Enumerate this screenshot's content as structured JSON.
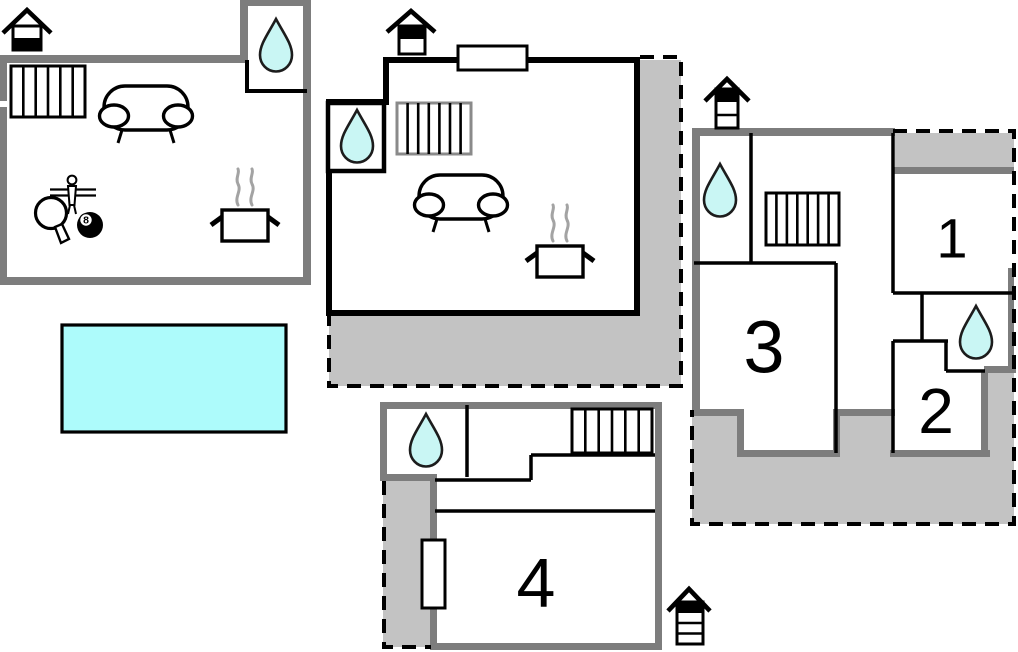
{
  "document": {
    "type": "holiday-home floor plan",
    "sections": 4
  },
  "colors": {
    "wall": "#7d7d7d",
    "terrace": "#c3c3c3",
    "pool": "#adfbfb",
    "water_drop": "#c9f6f4",
    "steam": "#a3a3a3",
    "line": "#000000",
    "background": "#ffffff"
  },
  "rooms": {
    "room1": "1",
    "room2": "2",
    "room3": "3",
    "room4": "4"
  },
  "game": {
    "billiard_ball_number": "8"
  },
  "icons": {
    "water_drop": "bathroom-water-drop",
    "stairs": "staircase",
    "sofa": "sofa-living-area",
    "pot": "kitchen-cooking-pot",
    "pool": "swimming-pool",
    "foosball": "foosball-figure",
    "table_tennis": "table-tennis-paddle",
    "billiards": "eight-ball",
    "house_level_a": "house-level-indicator-lower-of-2",
    "house_level_b": "house-level-indicator-upper-of-2",
    "house_level_c": "house-level-indicator-top-of-3",
    "house_level_d": "house-level-indicator-top-of-4"
  }
}
